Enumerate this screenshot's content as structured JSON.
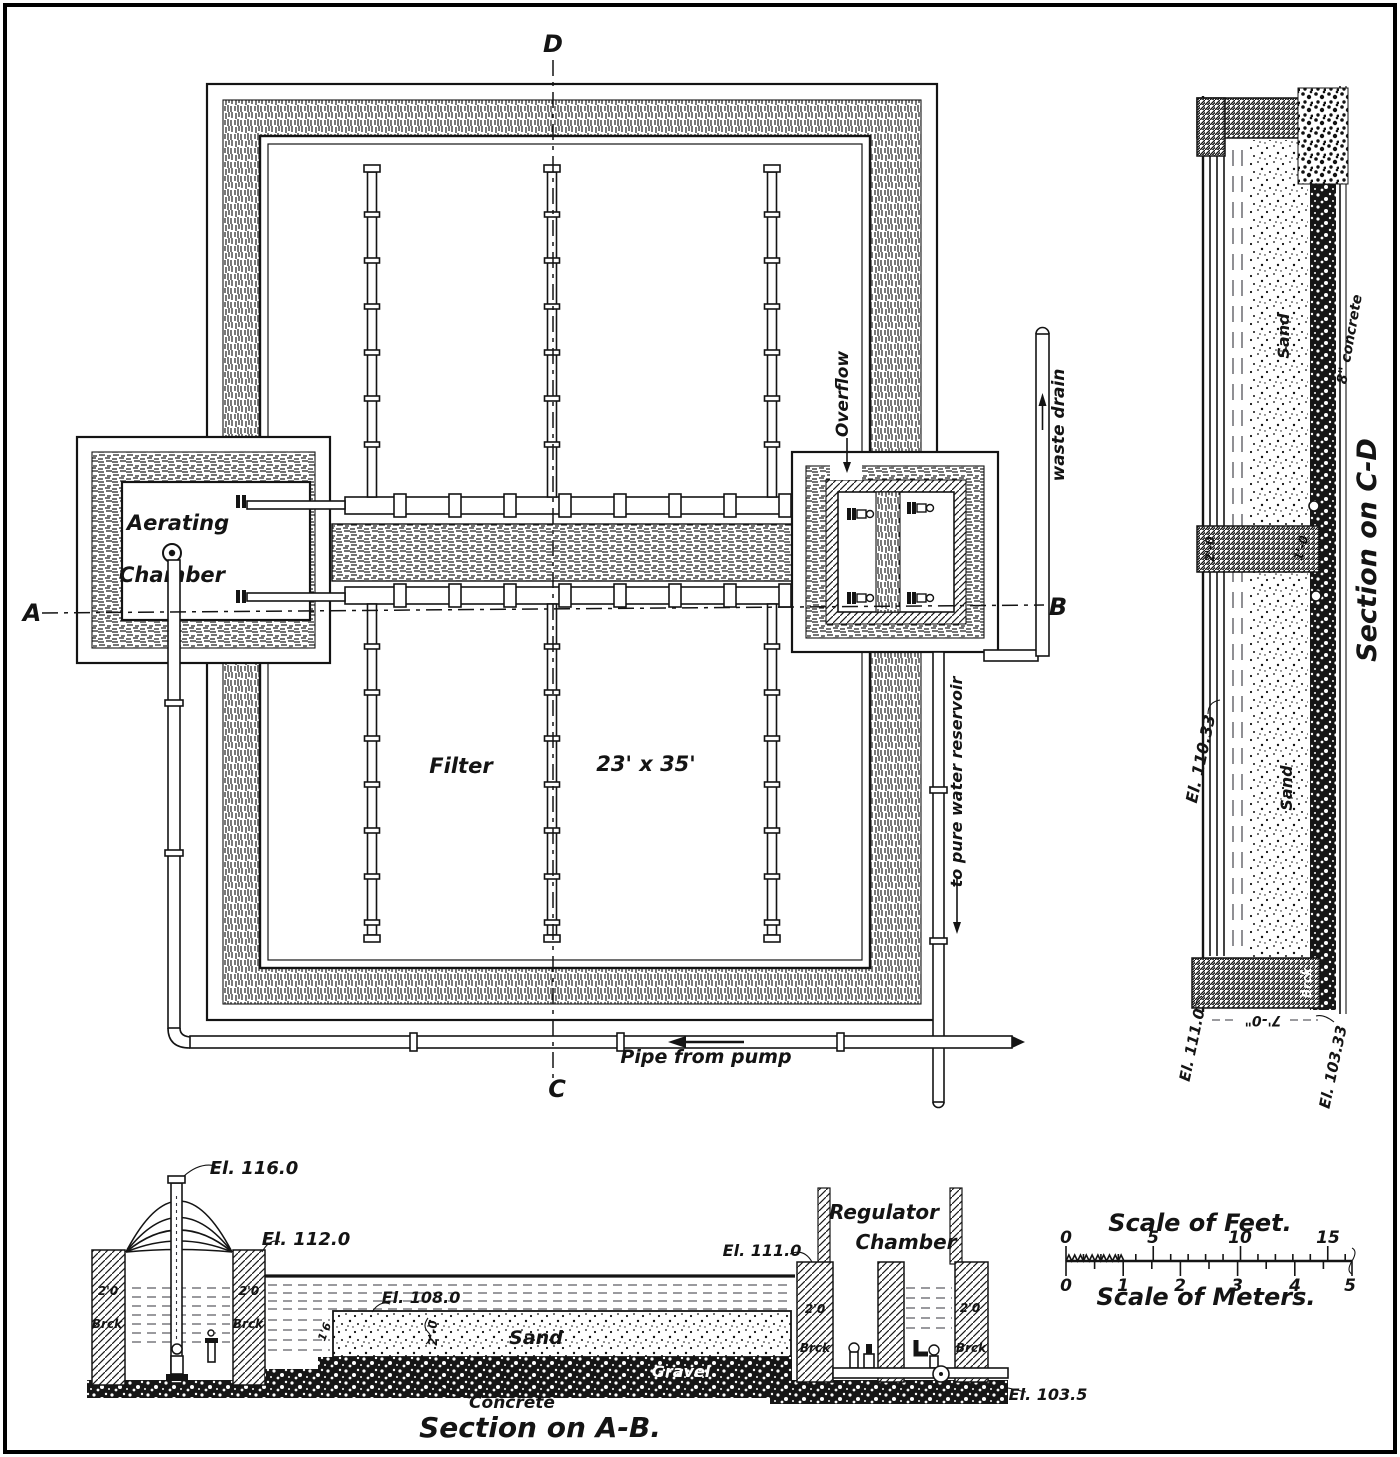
{
  "frame": {
    "background": "#ffffff",
    "ink": "#141414",
    "border": "#000000"
  },
  "plan": {
    "aerating_chamber_line1": "Aerating",
    "aerating_chamber_line2": "Chamber",
    "filter_label": "Filter",
    "filter_dimensions": "23' x 35'",
    "overflow_label": "Overflow",
    "waste_drain_label": "waste drain",
    "pure_water_label": "to pure water reservoir",
    "pipe_from_pump_label": "Pipe from pump",
    "marker_a": "A",
    "marker_b": "B",
    "marker_c": "C",
    "marker_d": "D"
  },
  "section_cd": {
    "title": "Section on C-D",
    "sand_upper_label": "Sand",
    "sand_lower_label": "Sand",
    "concrete_note": "8\" concrete",
    "el_top_wall": "El. 110.33",
    "el_floor": "El. 111.0",
    "el_bottom": "El. 103.33",
    "dim_width": "7'-0\"",
    "dim_wall_left": "2'-0",
    "dim_wall_right": "1'-0",
    "brick_label": "Brck"
  },
  "section_ab": {
    "title": "Section on A-B.",
    "el_vent_top": "El. 116.0",
    "el_wall_top": "El. 112.0",
    "el_water": "El. 108.0",
    "el_regulator": "El. 111.0",
    "el_outlet": "El. 103.5",
    "regulator_line1": "Regulator",
    "regulator_line2": "Chamber",
    "sand_label": "Sand",
    "gravel_label": "Gravel",
    "concrete_label": "Concrete",
    "brick_label_1": "Brck",
    "brick_label_2": "Brck",
    "brick_label_3": "Brck",
    "brick_label_4": "Brck",
    "wall_dim_1": "2'0",
    "wall_dim_2": "2'0",
    "wall_dim_3": "2'0",
    "wall_dim_4": "2'0",
    "sand_depth_dim": "2'-0",
    "gravel_depth_dim": "1'6"
  },
  "scales": {
    "feet_title": "Scale of Feet.",
    "feet_ticks": [
      "0",
      "5",
      "10",
      "15"
    ],
    "meters_title": "Scale of Meters.",
    "meter_ticks": [
      "0",
      "1",
      "2",
      "3",
      "4",
      "5"
    ]
  }
}
